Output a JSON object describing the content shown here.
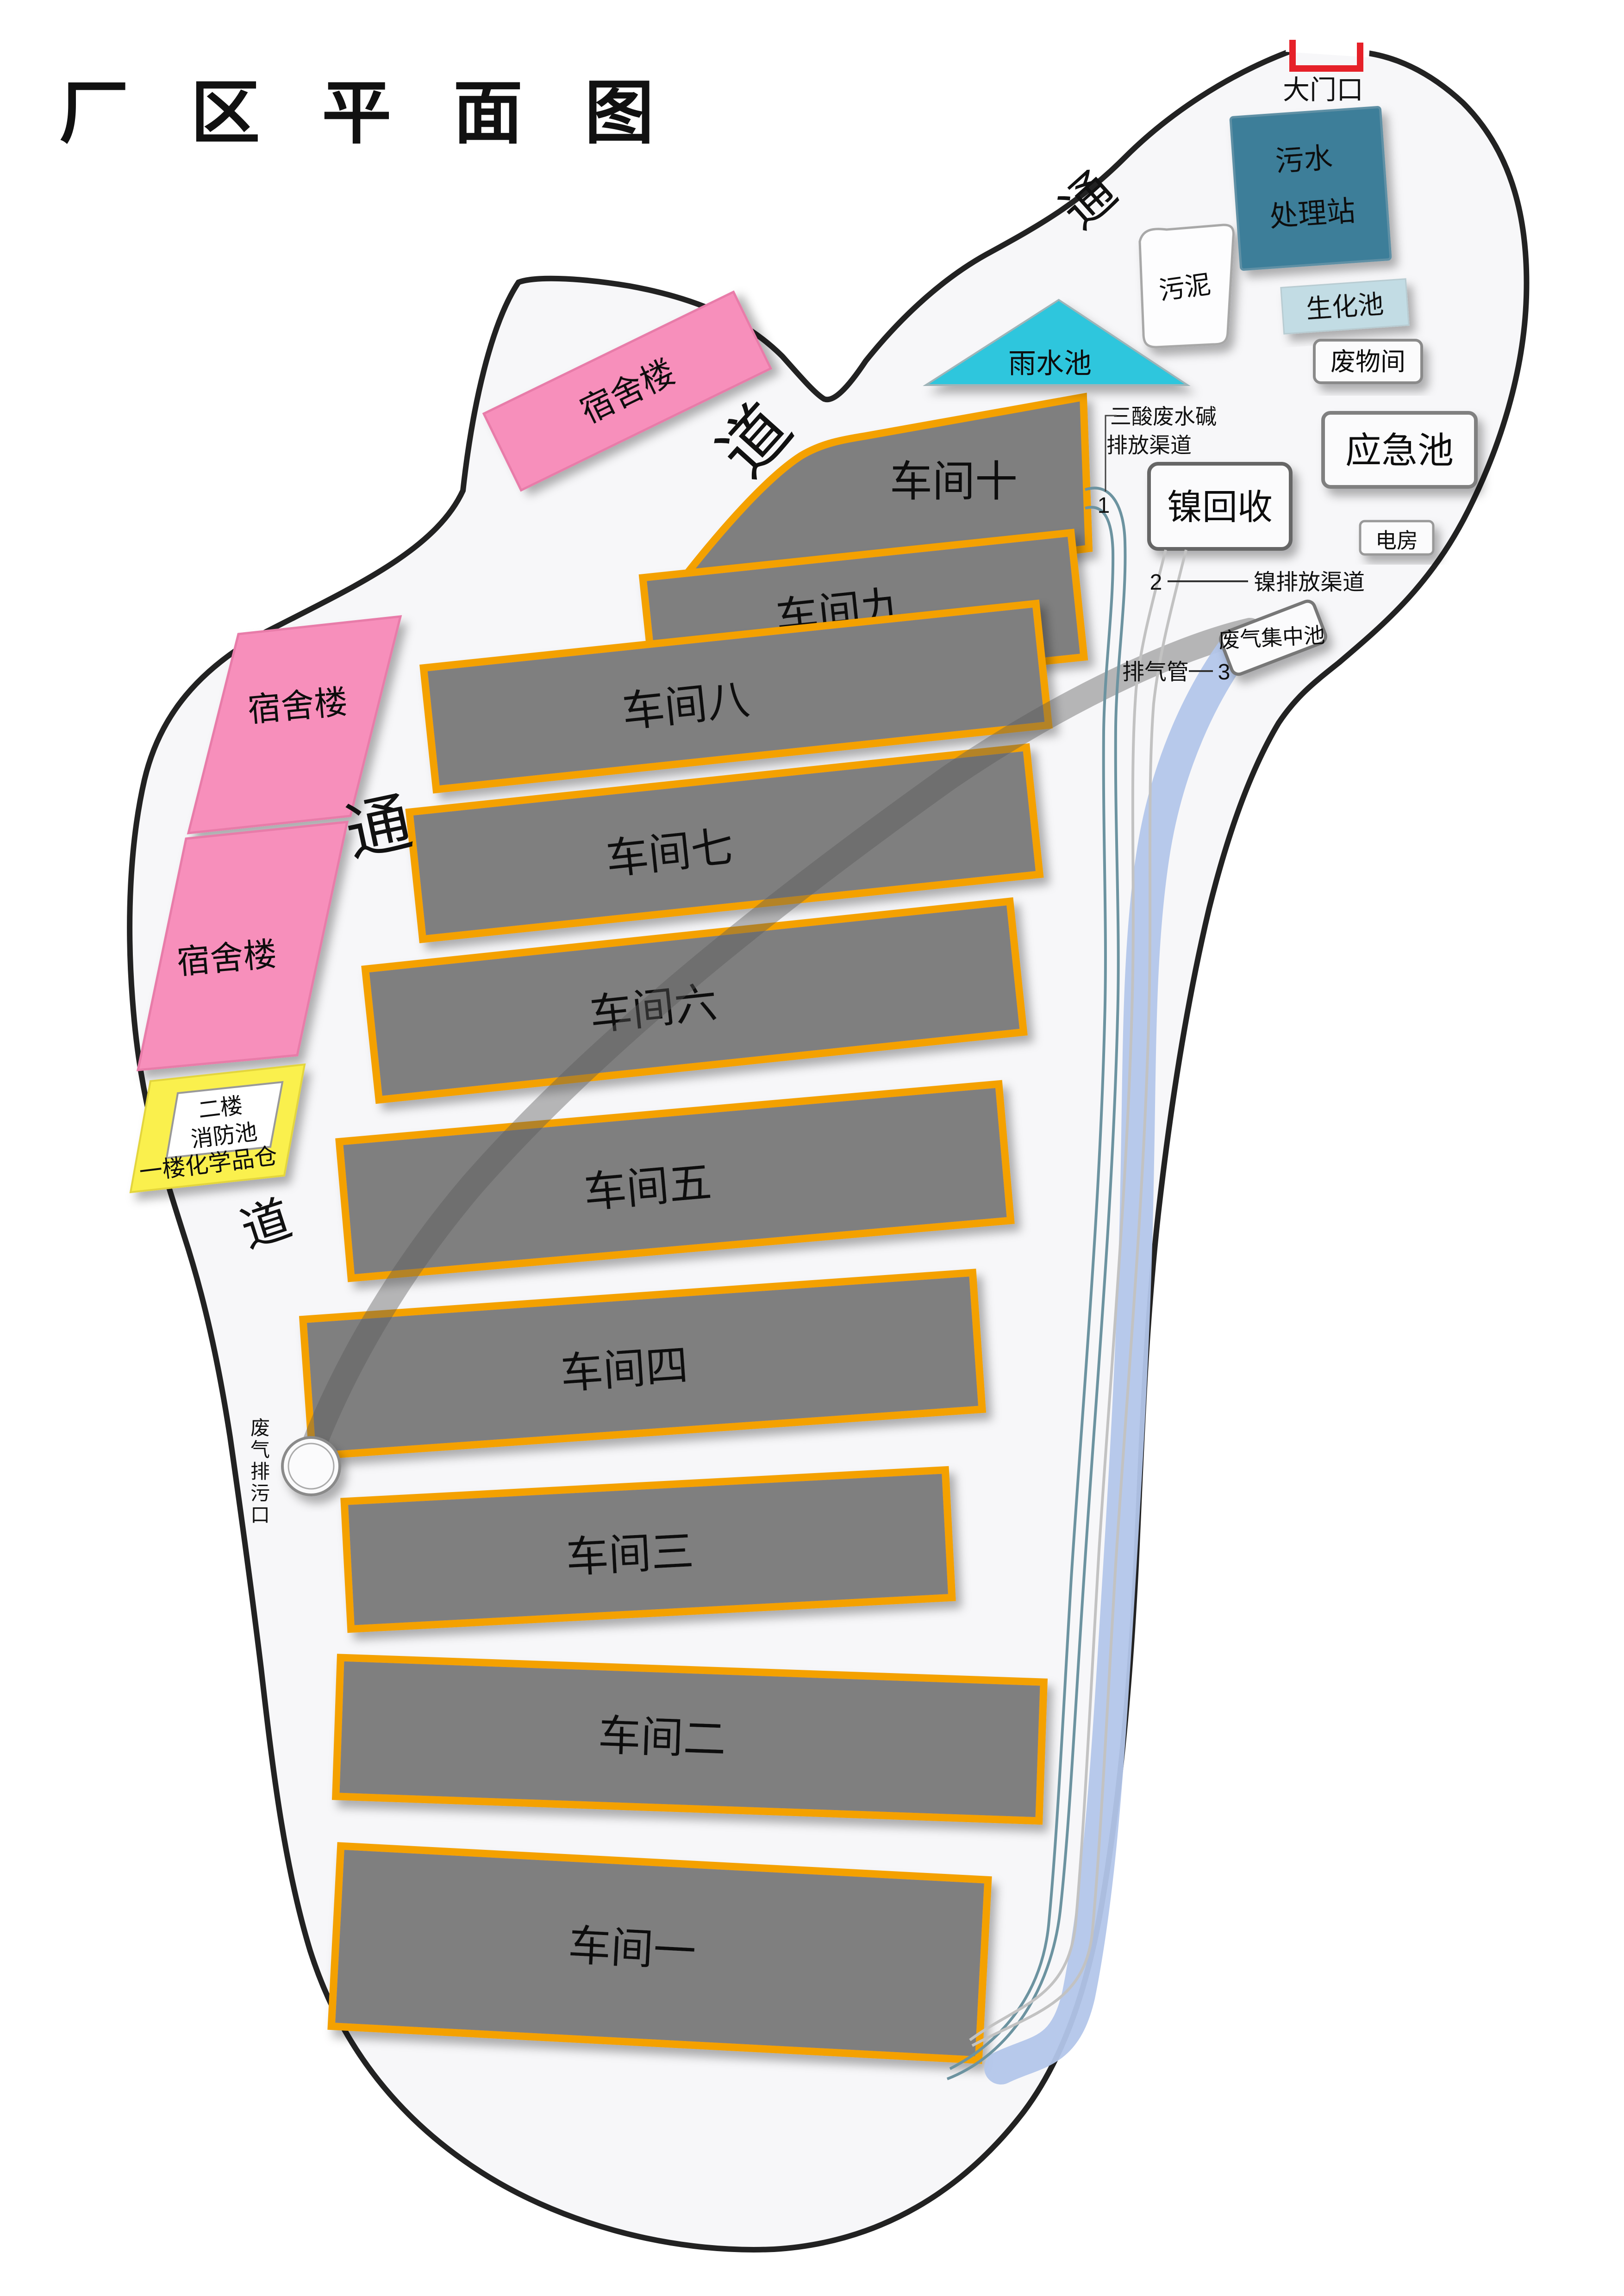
{
  "title": "厂 区 平 面 图",
  "gate": {
    "label": "大门口"
  },
  "passage": {
    "tong_top": "通",
    "dao_top": "道",
    "tong_left": "通",
    "dao_left": "道"
  },
  "buildings": {
    "dorm_top": "宿舍楼",
    "dorm_left_upper": "宿舍楼",
    "dorm_left_lower": "宿舍楼",
    "sludge": "污泥",
    "sewage_line1": "污水",
    "sewage_line2": "处理站",
    "biochem_pool": "生化池",
    "waste_room": "废物间",
    "emergency_pool": "应急池",
    "power_room": "电房",
    "nickel_recovery": "镍回收",
    "rainwater_pool": "雨水池",
    "waste_gas_pool": "废气集中池",
    "chem_line1": "二楼",
    "chem_line2": "消防池",
    "chem_bottom": "一楼化学品仓"
  },
  "workshops": [
    {
      "label": "车间十"
    },
    {
      "label": "车间九"
    },
    {
      "label": "车间八"
    },
    {
      "label": "车间七"
    },
    {
      "label": "车间六"
    },
    {
      "label": "车间五"
    },
    {
      "label": "车间四"
    },
    {
      "label": "车间三"
    },
    {
      "label": "车间二"
    },
    {
      "label": "车间一"
    }
  ],
  "annotations": {
    "acid_line1": "三酸废水碱",
    "acid_line2": "排放渠道",
    "num1": "1",
    "num2": "2",
    "nickel_channel": "镍排放渠道",
    "exhaust_pipe": "排气管",
    "num3": "3"
  },
  "outlet_label_chars": [
    "废",
    "气",
    "排",
    "污",
    "口"
  ],
  "colors": {
    "workshop_fill": "#7f7f7f",
    "workshop_border": "#F4A100",
    "dorm_pink": "#F78FBB",
    "dorm_border": "#E87CA9",
    "chem_yellow": "#FAF04E",
    "rain_cyan": "#2EC6DD",
    "sewage_teal": "#3E7E99",
    "biochem_blue": "#C2DCE4",
    "gate_red": "#E62129",
    "pipe_blue": "#B3C6EA",
    "channel_teal": "#6C93A0",
    "channel_gray": "#C2C2C2",
    "road_gray": "#5a5a5a"
  }
}
